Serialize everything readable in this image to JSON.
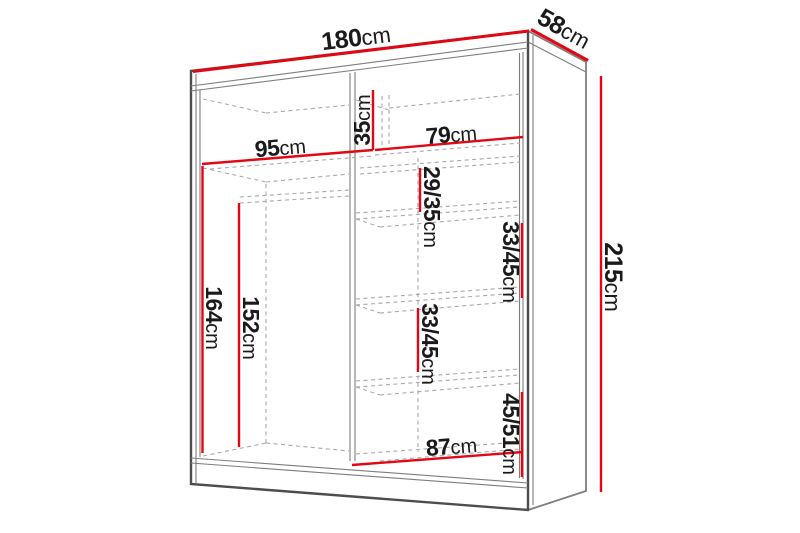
{
  "colors": {
    "dimension_red": "#e30613",
    "outline_dark": "#4d4d4d",
    "outline_mid": "#7d7d7d",
    "hidden_dash": "#a8a8a8",
    "label_text": "#1a1a1a",
    "background": "#ffffff"
  },
  "dims": {
    "total_width": {
      "value": "180",
      "unit": "cm"
    },
    "total_depth": {
      "value": "58",
      "unit": "cm"
    },
    "total_height": {
      "value": "215",
      "unit": "cm"
    },
    "left_section_width": {
      "value": "95",
      "unit": "cm"
    },
    "top_compartment_height": {
      "value": "35",
      "unit": "cm"
    },
    "right_section_width": {
      "value": "79",
      "unit": "cm"
    },
    "upper_shelf_gap": {
      "value": "29/35",
      "unit": "cm"
    },
    "middle_shelf_gap_right": {
      "value": "33/45",
      "unit": "cm"
    },
    "middle_shelf_gap_left": {
      "value": "33/45",
      "unit": "cm"
    },
    "hanging_space_height": {
      "value": "164",
      "unit": "cm"
    },
    "rail_height": {
      "value": "152",
      "unit": "cm"
    },
    "bottom_shelf_gap": {
      "value": "45/51",
      "unit": "cm"
    },
    "bottom_section_width": {
      "value": "87",
      "unit": "cm"
    }
  }
}
